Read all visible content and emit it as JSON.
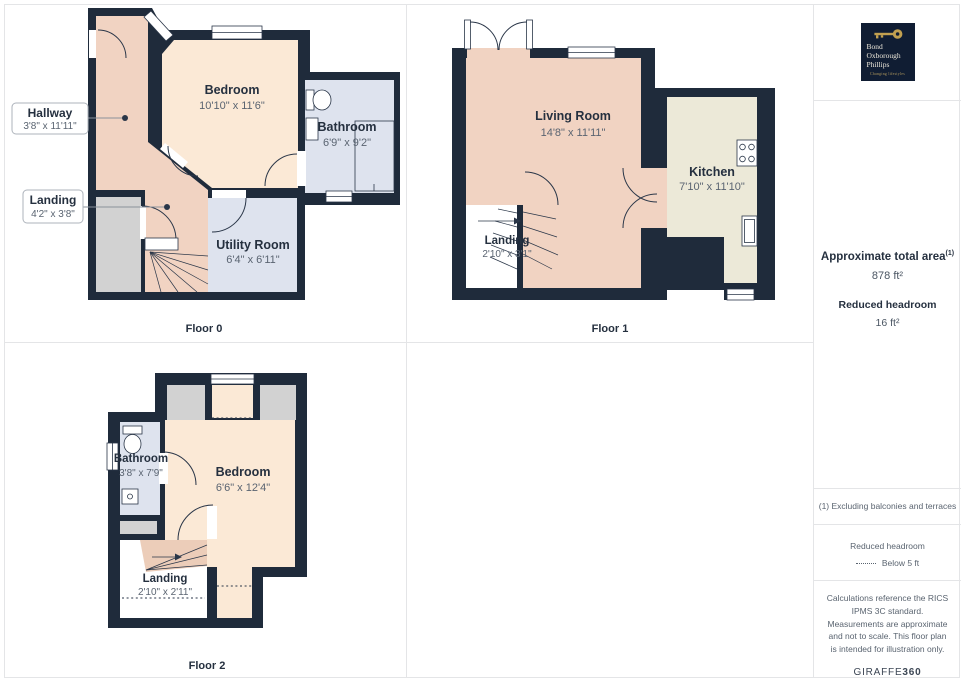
{
  "branding": {
    "logo_name_lines": [
      "Bond",
      "Oxborough",
      "Phillips"
    ],
    "logo_tagline": "Changing lifestyles",
    "watermark": "GIRAFFE",
    "watermark_bold": "360"
  },
  "summary": {
    "total_area_label": "Approximate total area",
    "total_area_footnote_marker": "(1)",
    "total_area_value": "878 ft²",
    "reduced_headroom_label": "Reduced headroom",
    "reduced_headroom_value": "16 ft²"
  },
  "legend": {
    "footnote": "(1) Excluding balconies and terraces",
    "reduced_headroom_title": "Reduced headroom",
    "reduced_headroom_desc": "Below 5 ft",
    "disclaimer": "Calculations reference the RICS IPMS 3C standard. Measurements are approximate and not to scale. This floor plan is intended for illustration only."
  },
  "floors": [
    {
      "name": "Floor 0",
      "rooms": [
        {
          "label": "Bedroom",
          "dims": "10'10\" x 11'6\""
        },
        {
          "label": "Bathroom",
          "dims": "6'9\" x 9'2\""
        },
        {
          "label": "Utility Room",
          "dims": "6'4\" x 6'11\""
        }
      ],
      "callouts": [
        {
          "label": "Hallway",
          "dims": "3'8\" x 11'11\""
        },
        {
          "label": "Landing",
          "dims": "4'2\" x 3'8\""
        }
      ]
    },
    {
      "name": "Floor 1",
      "rooms": [
        {
          "label": "Living Room",
          "dims": "14'8\" x 11'11\""
        },
        {
          "label": "Kitchen",
          "dims": "7'10\" x 11'10\""
        },
        {
          "label": "Landing",
          "dims": "2'10\" x 3'1\""
        }
      ]
    },
    {
      "name": "Floor 2",
      "rooms": [
        {
          "label": "Bedroom",
          "dims": "6'6\" x 12'4\""
        },
        {
          "label": "Bathroom",
          "dims": "3'8\" x 7'9\""
        },
        {
          "label": "Landing",
          "dims": "2'10\" x 2'11\""
        }
      ]
    }
  ],
  "palette": {
    "wall": "#1f2b3b",
    "room_warm": "#f1d3c2",
    "room_light": "#fbe9d6",
    "room_kitchen": "#ece9d8",
    "room_wet": "#dee3ee",
    "room_gray": "#d2d2d2",
    "stairs": "#eccdb9",
    "logo_navy": "#101d33",
    "logo_gold": "#c2a050",
    "page_border": "#e4e5e7"
  }
}
